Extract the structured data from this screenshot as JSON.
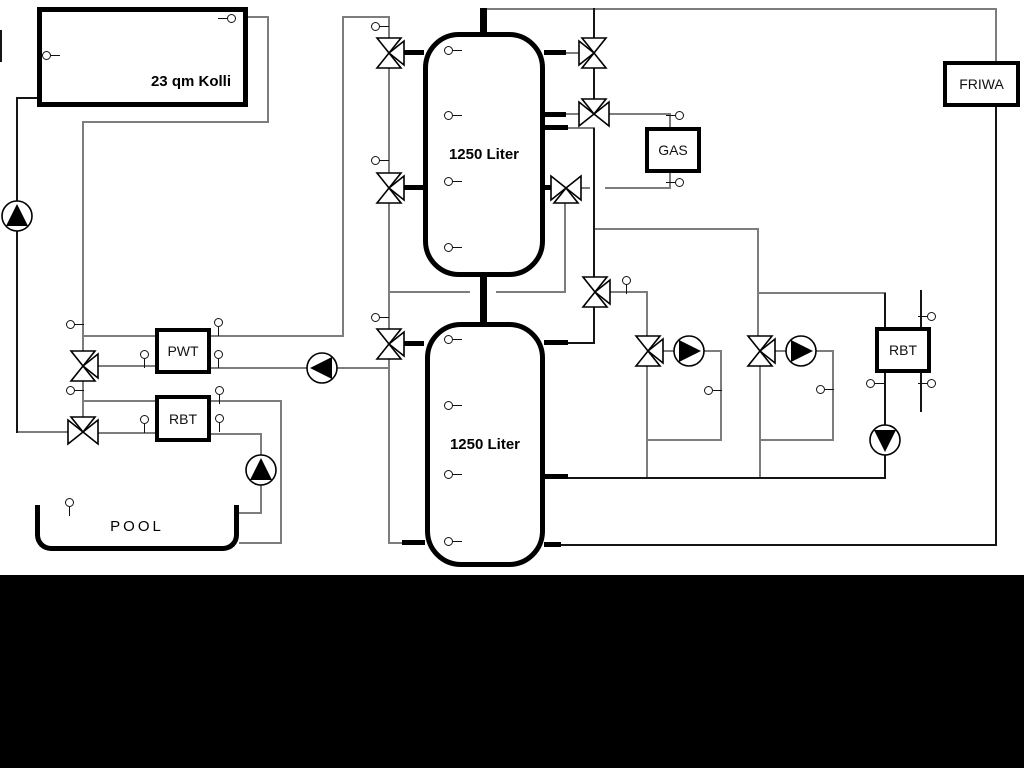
{
  "labels": {
    "collector": "23 qm Kolli",
    "tank_upper": "1250 Liter",
    "tank_lower": "1250 Liter",
    "pwt": "PWT",
    "rbt_left": "RBT",
    "gas": "GAS",
    "rbt_right": "RBT",
    "friwa": "FRIWA",
    "pool": "POOL"
  },
  "colors": {
    "pipe_gray": "#7d7d7d",
    "pipe_black": "#151515",
    "outline_black": "#000000",
    "background": "#ffffff",
    "band_black": "#000000"
  },
  "components": {
    "pumps": [
      {
        "name": "solar-pump",
        "direction": "up"
      },
      {
        "name": "pwt-pump",
        "direction": "left"
      },
      {
        "name": "pool-pump",
        "direction": "up"
      },
      {
        "name": "heating-circuit-1-pump",
        "direction": "right"
      },
      {
        "name": "heating-circuit-2-pump",
        "direction": "right"
      },
      {
        "name": "rbt-right-pump",
        "direction": "down"
      }
    ],
    "valves": [
      "solar-pwt-3way-valve",
      "solar-return-3way-valve",
      "tank-charge-top-3way-valve",
      "tank-charge-mid-3way-valve",
      "tank-charge-low-3way-valve",
      "gas-flow-3way-valve",
      "gas-mid-3way-valve",
      "gas-return-3way-valve",
      "heating-supply-3way-valve",
      "heating-circuit-1-valve",
      "heating-circuit-2-valve"
    ],
    "sensor_count": 30
  }
}
